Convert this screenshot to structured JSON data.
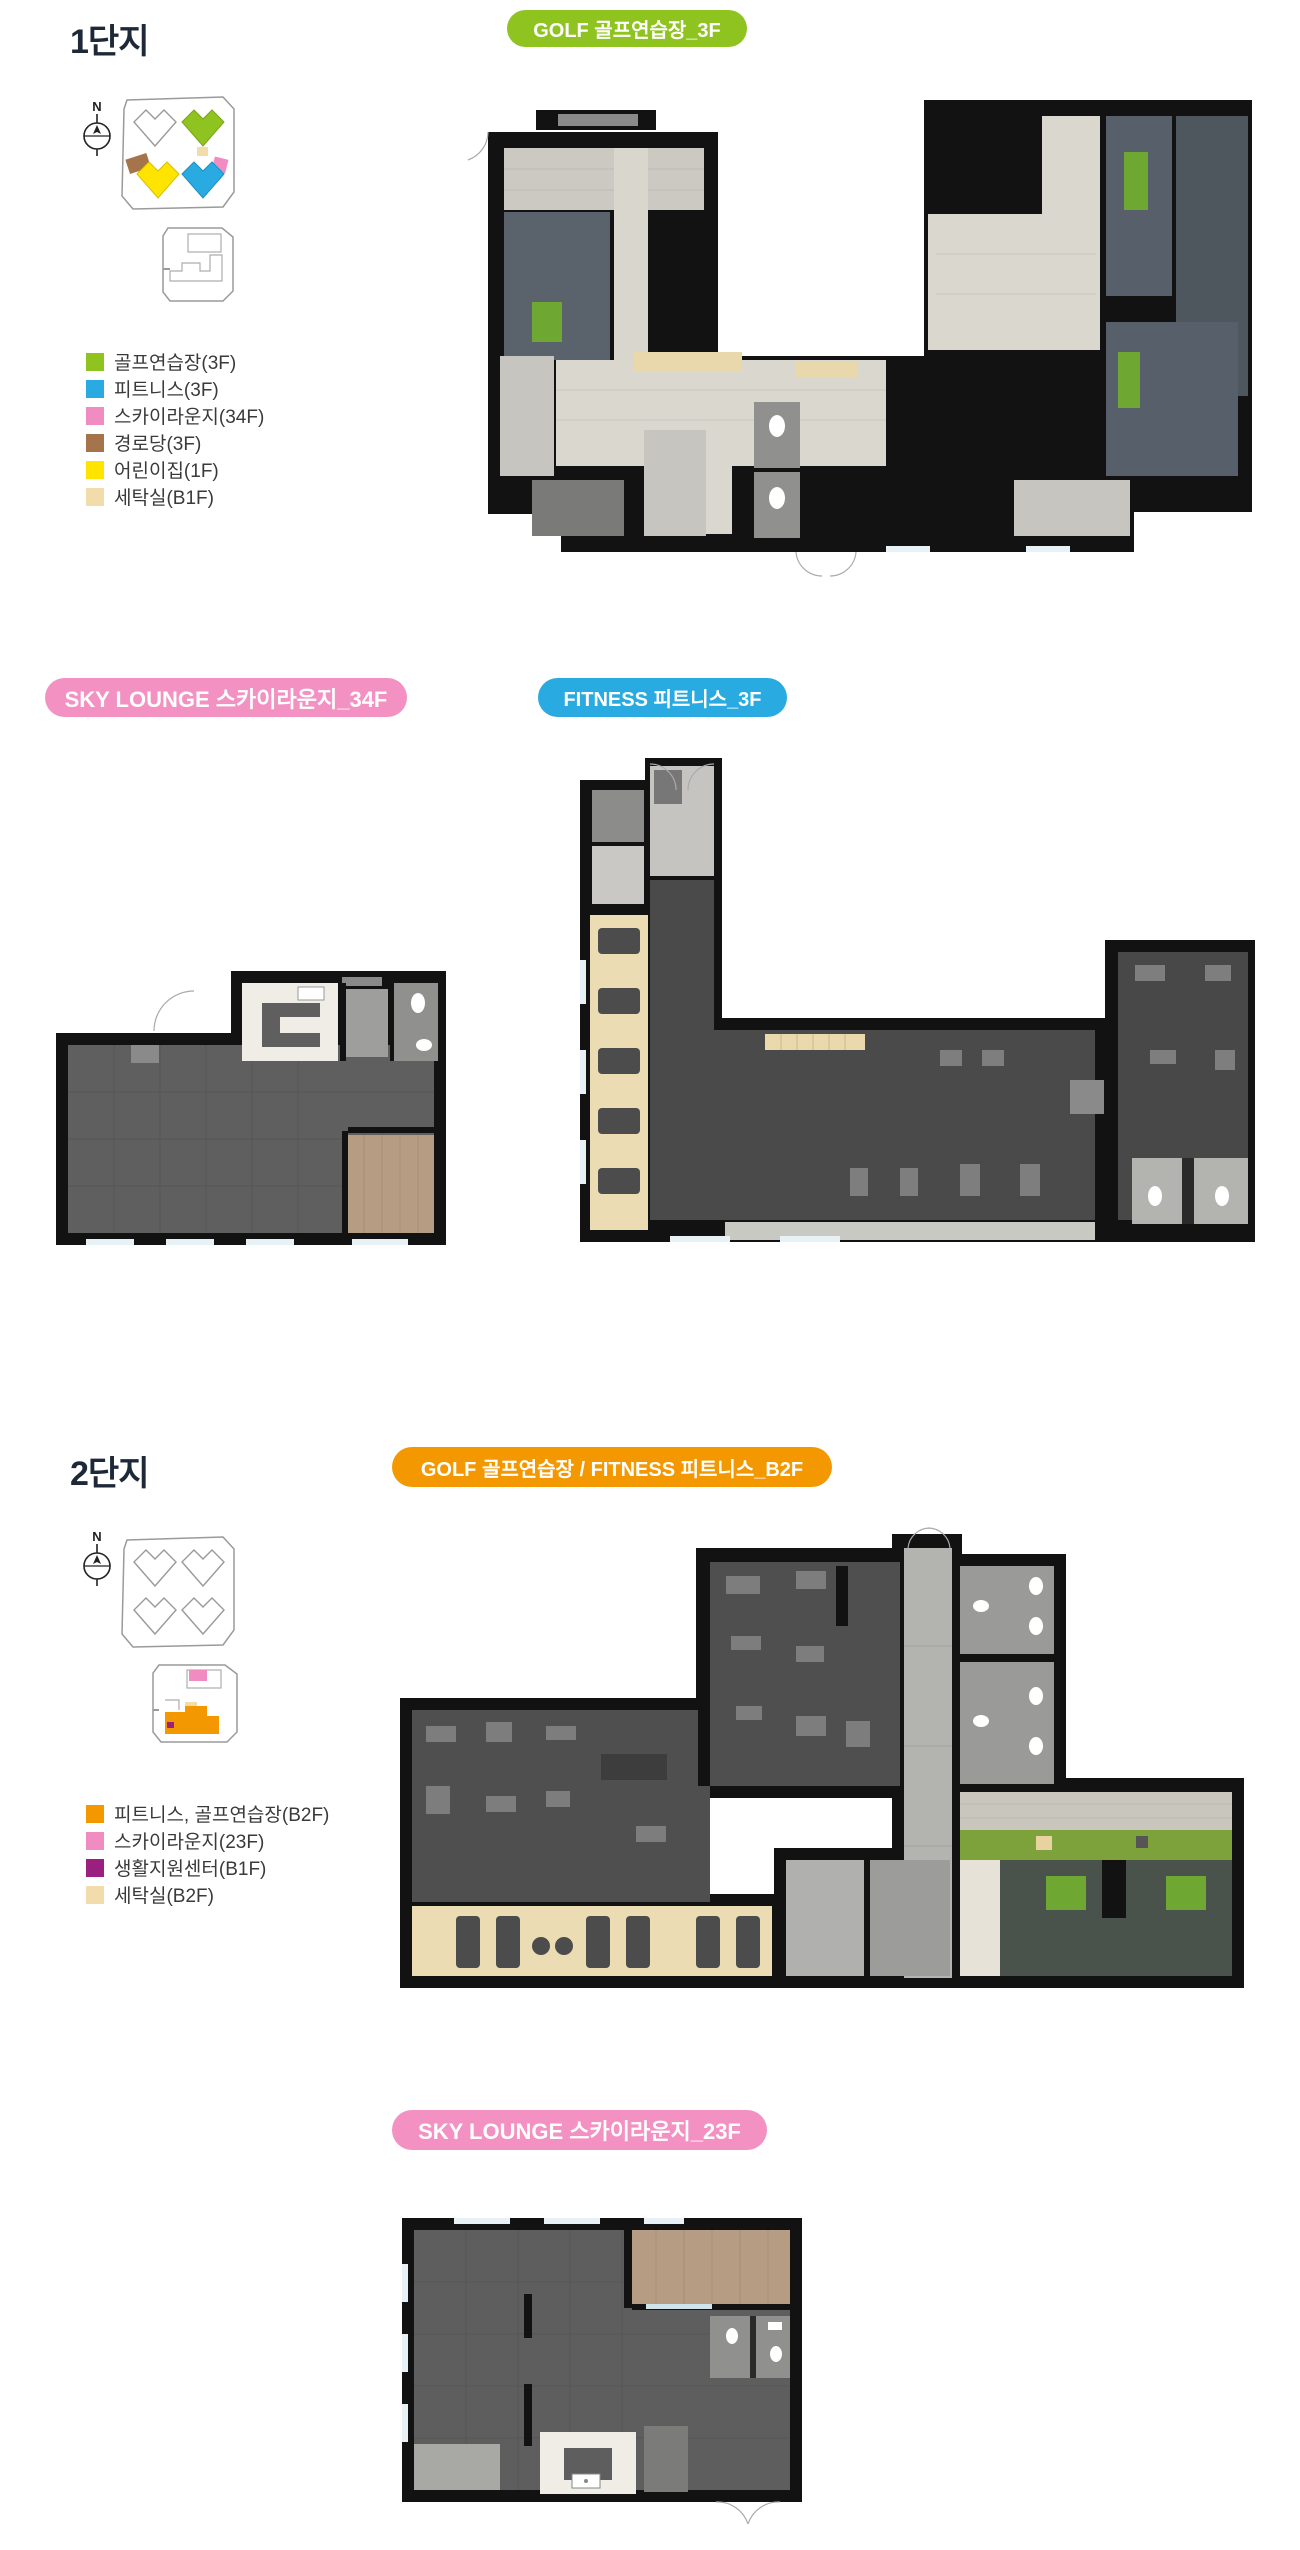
{
  "colors": {
    "green": "#8fc31f",
    "blue": "#29abe2",
    "badge_pink": "#f291c2",
    "legend_pink": "#f08cc1",
    "brown": "#a5744b",
    "yellow": "#ffe400",
    "beige": "#f2dcab",
    "orange": "#f39800",
    "purple": "#9b1f7e"
  },
  "section1": {
    "title": "1단지",
    "compass_label": "N",
    "badge_golf": {
      "label": "GOLF 골프연습장_3F",
      "color": "#8fc31f"
    },
    "badge_sky": {
      "label": "SKY LOUNGE 스카이라운지_34F",
      "color": "#f291c2"
    },
    "badge_fitness": {
      "label": "FITNESS 피트니스_3F",
      "color": "#29abe2"
    },
    "legend": [
      {
        "label": "골프연습장(3F)",
        "color": "#8fc31f"
      },
      {
        "label": "피트니스(3F)",
        "color": "#29abe2"
      },
      {
        "label": "스카이라운지(34F)",
        "color": "#f08cc1"
      },
      {
        "label": "경로당(3F)",
        "color": "#a5744b"
      },
      {
        "label": "어린이집(1F)",
        "color": "#ffe400"
      },
      {
        "label": "세탁실(B1F)",
        "color": "#f2dcab"
      }
    ]
  },
  "section2": {
    "title": "2단지",
    "compass_label": "N",
    "badge_golf_fitness": {
      "label": "GOLF 골프연습장 / FITNESS 피트니스_B2F",
      "color": "#f39800"
    },
    "badge_sky": {
      "label": "SKY LOUNGE 스카이라운지_23F",
      "color": "#f291c2"
    },
    "legend": [
      {
        "label": "피트니스, 골프연습장(B2F)",
        "color": "#f39800"
      },
      {
        "label": "스카이라운지(23F)",
        "color": "#f08cc1"
      },
      {
        "label": "생활지원센터(B1F)",
        "color": "#9b1f7e"
      },
      {
        "label": "세탁실(B2F)",
        "color": "#f2dcab"
      }
    ]
  }
}
